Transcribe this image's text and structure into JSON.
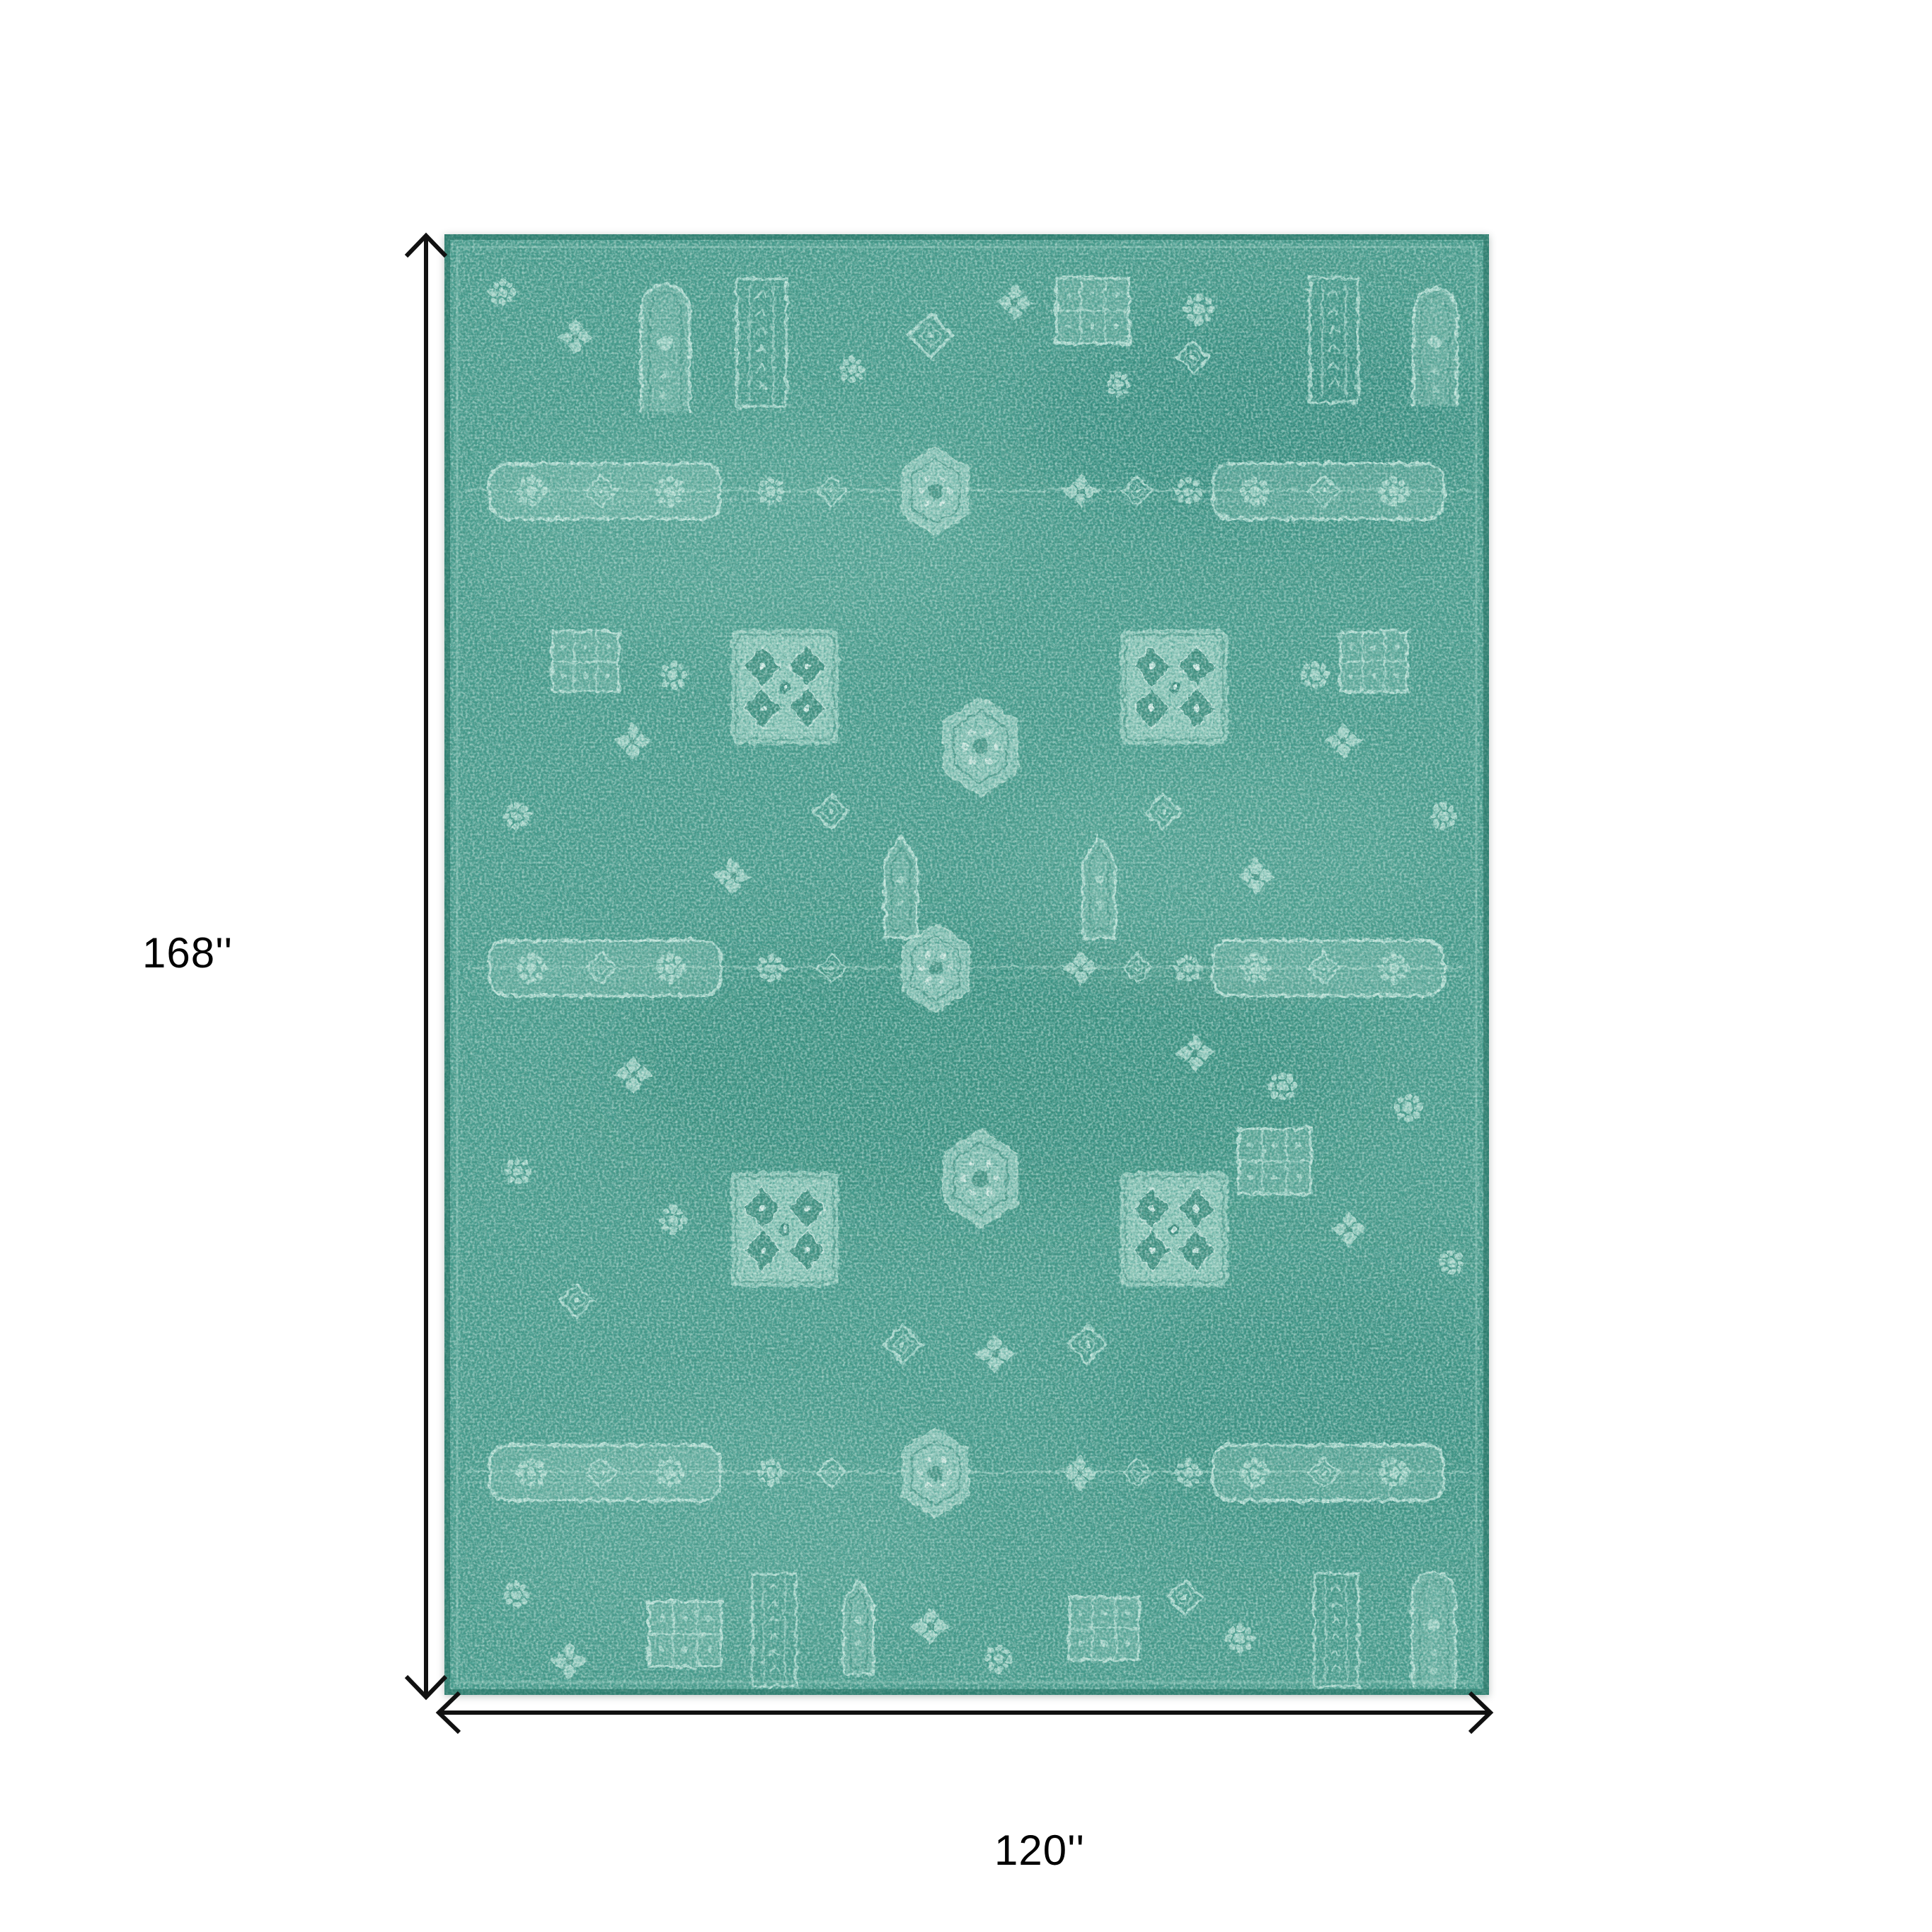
{
  "diagram": {
    "height_label": "168''",
    "width_label": "120''"
  },
  "rug": {
    "description": "distressed vintage oriental pattern rug",
    "orientation": "vertical rectangle"
  },
  "colors": {
    "page-bg": "#ffffff",
    "dimension-line": "#111111",
    "label-text": "#000000",
    "rug-base": "#4a9a8b",
    "rug-dark": "#155e50",
    "rug-light": "#cceee1",
    "rug-light2": "#9cd2c5",
    "rug-edge": "#1c685a",
    "motif": "#c3e5db",
    "motif-fill": "#aed9cd",
    "dark-accent": "#26796a"
  }
}
